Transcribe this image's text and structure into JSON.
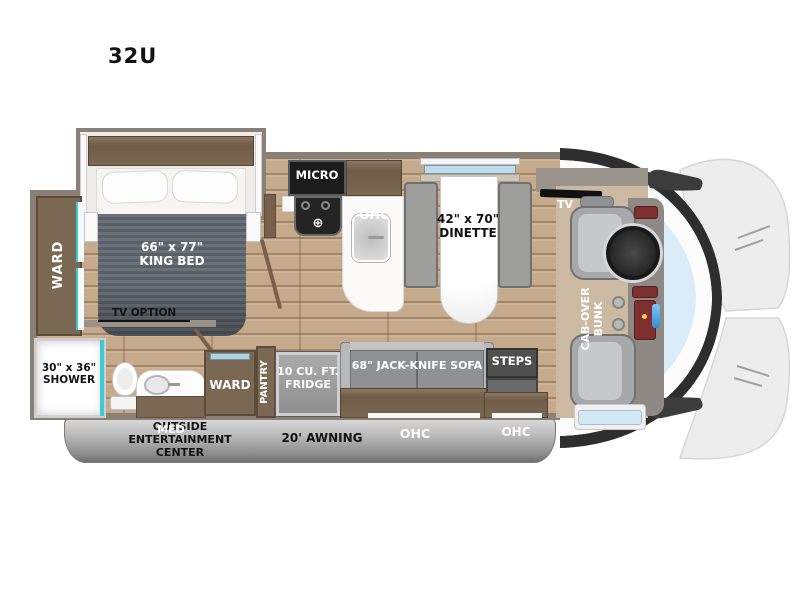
{
  "title": "32U",
  "colors": {
    "wall": "#8a8076",
    "floor_wood": "#c6aa8c",
    "cabinet_brown": "#7b6853",
    "mattress_gray": "#5f666d",
    "seat_gray": "#a6a8aa",
    "windshield_blue": "#d9ecf8",
    "shower_glass_teal": "#3cc9d8",
    "steps_gray": "#4f4f4f",
    "awning_gray": "#9f9f9f",
    "appliance_black": "#1c1c1c"
  },
  "labels": {
    "bedroom_ohc": "OHC",
    "king_bed": "66\" x 77\"\nKING BED",
    "ward_bedroom": "WARD",
    "tv_option": "TV OPTION",
    "shower": "30\" x 36\"\nSHOWER",
    "med": "MED",
    "micro": "MICRO",
    "kitchen_ohc": "OHC",
    "dinette": "42\" x 70\"\nDINETTE",
    "tv": "TV",
    "cab_over_bunk": "CAB-OVER\nBUNK",
    "ward_hall": "WARD",
    "pantry": "PANTRY",
    "fridge": "10 CU. FT.\nFRIDGE",
    "sofa": "68\" JACK-KNIFE SOFA",
    "sofa_ohc": "OHC",
    "steps": "STEPS",
    "entry_ohc": "OHC",
    "outside_entertainment": "OUTSIDE\nENTERTAINMENT\nCENTER",
    "awning": "20' AWNING"
  }
}
